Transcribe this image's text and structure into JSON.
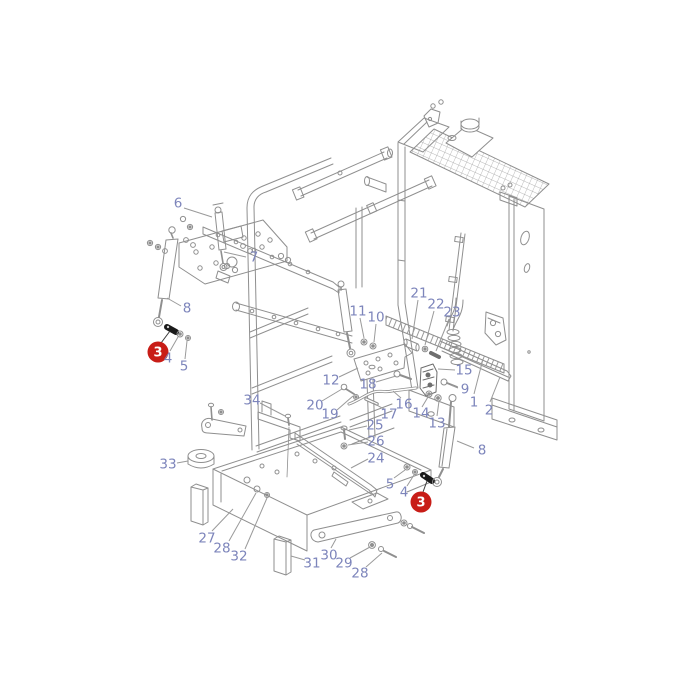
{
  "diagram": {
    "type": "exploded-parts-diagram",
    "subject": "radiator-mounting-assembly",
    "colors": {
      "background": "#ffffff",
      "line_art": "#8f8f8f",
      "callout_text": "#7d85bb",
      "leader": "#9a9a9a",
      "badge_fill": "#c81d17",
      "badge_text": "#ffffff",
      "badge_leader": "#3a3a3a"
    },
    "callouts": [
      {
        "label": "6",
        "x": 178,
        "y": 203,
        "style": "plain",
        "leader": [
          184,
          208,
          212,
          217
        ]
      },
      {
        "label": "7",
        "x": 254,
        "y": 257,
        "style": "plain",
        "leader": [
          246,
          257,
          224,
          252
        ]
      },
      {
        "label": "8",
        "x": 187,
        "y": 308,
        "style": "plain",
        "leader": [
          181,
          306,
          167,
          298
        ]
      },
      {
        "label": "3",
        "x": 158,
        "y": 352,
        "style": "badge",
        "leader": [
          161,
          343,
          170,
          331
        ]
      },
      {
        "label": "4",
        "x": 168,
        "y": 358,
        "style": "plain",
        "leader": [
          170,
          351,
          178,
          337
        ]
      },
      {
        "label": "5",
        "x": 184,
        "y": 366,
        "style": "plain",
        "leader": [
          185,
          359,
          187,
          341
        ]
      },
      {
        "label": "11",
        "x": 358,
        "y": 311,
        "style": "plain",
        "leader": [
          360,
          318,
          364,
          338
        ]
      },
      {
        "label": "10",
        "x": 376,
        "y": 317,
        "style": "plain",
        "leader": [
          376,
          324,
          374,
          342
        ]
      },
      {
        "label": "21",
        "x": 419,
        "y": 293,
        "style": "plain",
        "leader": [
          418,
          300,
          412,
          339
        ]
      },
      {
        "label": "22",
        "x": 436,
        "y": 304,
        "style": "plain",
        "leader": [
          434,
          311,
          425,
          345
        ]
      },
      {
        "label": "23",
        "x": 452,
        "y": 312,
        "style": "plain",
        "leader": [
          449,
          319,
          436,
          351
        ]
      },
      {
        "label": "15",
        "x": 464,
        "y": 370,
        "style": "plain",
        "leader": [
          455,
          370,
          438,
          369
        ]
      },
      {
        "label": "9",
        "x": 465,
        "y": 389,
        "style": "plain",
        "leader": [
          458,
          388,
          451,
          385
        ]
      },
      {
        "label": "1",
        "x": 474,
        "y": 402,
        "style": "plain",
        "leader": [
          474,
          394,
          483,
          359
        ]
      },
      {
        "label": "2",
        "x": 489,
        "y": 410,
        "style": "plain",
        "leader": [
          490,
          402,
          500,
          377
        ]
      },
      {
        "label": "12",
        "x": 331,
        "y": 380,
        "style": "plain",
        "leader": [
          339,
          377,
          358,
          368
        ]
      },
      {
        "label": "18",
        "x": 368,
        "y": 384,
        "style": "plain",
        "leader": [
          376,
          382,
          396,
          376
        ]
      },
      {
        "label": "20",
        "x": 315,
        "y": 405,
        "style": "plain",
        "leader": [
          322,
          401,
          342,
          389
        ]
      },
      {
        "label": "19",
        "x": 330,
        "y": 414,
        "style": "plain",
        "leader": [
          337,
          410,
          353,
          396
        ]
      },
      {
        "label": "16",
        "x": 404,
        "y": 404,
        "style": "plain",
        "leader": [
          401,
          398,
          393,
          391
        ]
      },
      {
        "label": "17",
        "x": 389,
        "y": 414,
        "style": "plain",
        "leader": [
          384,
          409,
          373,
          403
        ]
      },
      {
        "label": "14",
        "x": 421,
        "y": 413,
        "style": "plain",
        "leader": [
          422,
          407,
          428,
          397
        ]
      },
      {
        "label": "13",
        "x": 437,
        "y": 423,
        "style": "plain",
        "leader": [
          437,
          416,
          439,
          401
        ]
      },
      {
        "label": "25",
        "x": 375,
        "y": 425,
        "style": "plain",
        "leader": [
          367,
          426,
          349,
          430
        ]
      },
      {
        "label": "26",
        "x": 376,
        "y": 441,
        "style": "plain",
        "leader": [
          368,
          442,
          348,
          445
        ]
      },
      {
        "label": "24",
        "x": 376,
        "y": 458,
        "style": "plain",
        "leader": [
          368,
          459,
          351,
          468
        ]
      },
      {
        "label": "34",
        "x": 252,
        "y": 400,
        "style": "plain",
        "leader": [
          260,
          403,
          285,
          416
        ]
      },
      {
        "label": "33",
        "x": 168,
        "y": 464,
        "style": "plain",
        "leader": [
          177,
          463,
          188,
          461
        ]
      },
      {
        "label": "27",
        "x": 207,
        "y": 538,
        "style": "plain",
        "leader": [
          212,
          531,
          233,
          509
        ]
      },
      {
        "label": "28",
        "x": 222,
        "y": 548,
        "style": "plain",
        "leader": [
          229,
          541,
          256,
          493
        ]
      },
      {
        "label": "32",
        "x": 239,
        "y": 556,
        "style": "plain",
        "leader": [
          245,
          549,
          267,
          498
        ]
      },
      {
        "label": "31",
        "x": 312,
        "y": 563,
        "style": "plain",
        "leader": [
          305,
          560,
          291,
          556
        ]
      },
      {
        "label": "30",
        "x": 329,
        "y": 555,
        "style": "plain",
        "leader": [
          331,
          548,
          336,
          539
        ]
      },
      {
        "label": "29",
        "x": 344,
        "y": 563,
        "style": "plain",
        "leader": [
          350,
          558,
          370,
          547
        ]
      },
      {
        "label": "28",
        "x": 360,
        "y": 573,
        "style": "plain",
        "leader": [
          366,
          567,
          382,
          553
        ]
      },
      {
        "label": "5",
        "x": 390,
        "y": 484,
        "style": "plain",
        "leader": [
          394,
          478,
          405,
          470
        ]
      },
      {
        "label": "4",
        "x": 404,
        "y": 492,
        "style": "plain",
        "leader": [
          407,
          486,
          414,
          475
        ]
      },
      {
        "label": "3",
        "x": 421,
        "y": 502,
        "style": "badge",
        "leader": [
          423,
          492,
          427,
          481
        ]
      },
      {
        "label": "8",
        "x": 482,
        "y": 450,
        "style": "plain",
        "leader": [
          474,
          448,
          457,
          441
        ]
      }
    ]
  }
}
